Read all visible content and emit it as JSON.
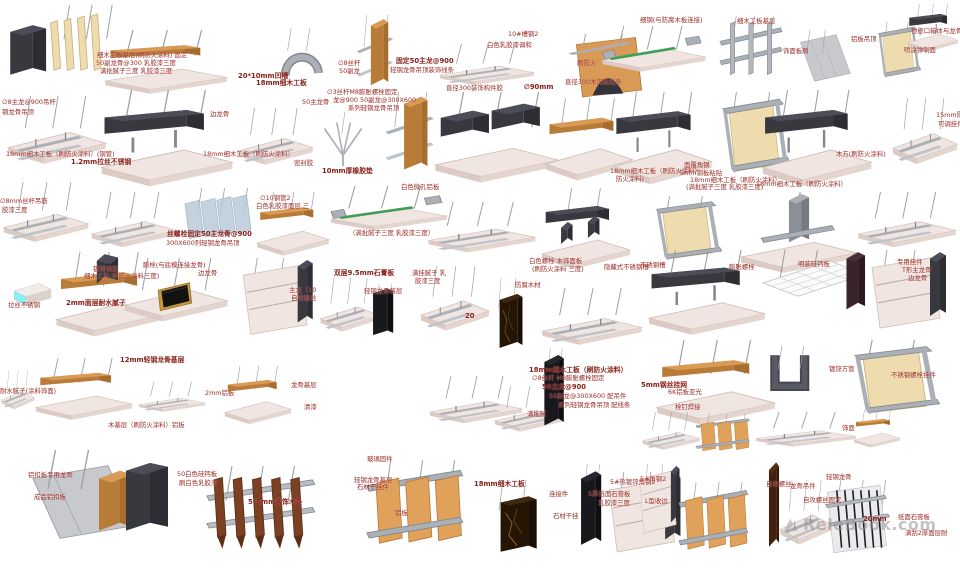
{
  "page": {
    "background": "#ffffff"
  },
  "watermark": {
    "text": "ReleBook.com"
  },
  "palette": {
    "annotation_red": "#9c2a24",
    "slab_pink": "#f1e5e1",
    "metal_gray": "#aab0b6",
    "charcoal": "#4d4d59",
    "wood_orange": "#d89a55",
    "green_strip": "#3f9e56",
    "cyan": "#8ceef0",
    "marble_brown": "#241505",
    "slat_brown": "#7c4023"
  },
  "details": [
    {
      "v": "slatscream",
      "x": 8,
      "y": 5,
      "w": 112,
      "h": 90
    },
    {
      "v": "woodtop",
      "x": 100,
      "y": 30,
      "w": 132,
      "h": 68
    },
    {
      "v": "grayarch",
      "x": 266,
      "y": 28,
      "w": 72,
      "h": 60
    },
    {
      "v": "woodvert",
      "x": 350,
      "y": 15,
      "w": 58,
      "h": 85
    },
    {
      "v": "flat",
      "x": 436,
      "y": 44,
      "w": 102,
      "h": 52
    },
    {
      "v": "archwood",
      "x": 556,
      "y": 34,
      "w": 102,
      "h": 70
    },
    {
      "v": "greenstrip",
      "x": 598,
      "y": 26,
      "w": 112,
      "h": 62
    },
    {
      "v": "postsframe",
      "x": 714,
      "y": 16,
      "w": 74,
      "h": 78
    },
    {
      "v": "grayslant",
      "x": 794,
      "y": 30,
      "w": 64,
      "h": 62
    },
    {
      "v": "framebox",
      "x": 864,
      "y": 22,
      "w": 66,
      "h": 66
    },
    {
      "v": "darkroof",
      "x": 906,
      "y": 4,
      "w": 54,
      "h": 50
    },
    {
      "v": "flat",
      "x": 4,
      "y": 96,
      "w": 106,
      "h": 86
    },
    {
      "v": "darkroof",
      "x": 96,
      "y": 90,
      "w": 142,
      "h": 100
    },
    {
      "v": "flat",
      "x": 234,
      "y": 108,
      "w": 82,
      "h": 72
    },
    {
      "v": "bracket",
      "x": 312,
      "y": 112,
      "w": 62,
      "h": 60
    },
    {
      "v": "woodvert",
      "x": 376,
      "y": 92,
      "w": 78,
      "h": 94
    },
    {
      "v": "twindark",
      "x": 430,
      "y": 92,
      "w": 134,
      "h": 94
    },
    {
      "v": "woodtop",
      "x": 542,
      "y": 98,
      "w": 94,
      "h": 88
    },
    {
      "v": "darkroof",
      "x": 610,
      "y": 92,
      "w": 106,
      "h": 96
    },
    {
      "v": "framebox",
      "x": 700,
      "y": 92,
      "w": 104,
      "h": 96
    },
    {
      "v": "darkroof",
      "x": 758,
      "y": 90,
      "w": 118,
      "h": 100
    },
    {
      "v": "flat",
      "x": 890,
      "y": 98,
      "w": 70,
      "h": 84
    },
    {
      "v": "flat",
      "x": 0,
      "y": 182,
      "w": 92,
      "h": 76
    },
    {
      "v": "flat",
      "x": 88,
      "y": 192,
      "w": 92,
      "h": 70
    },
    {
      "v": "glass",
      "x": 178,
      "y": 188,
      "w": 88,
      "h": 70
    },
    {
      "v": "woodtop",
      "x": 254,
      "y": 192,
      "w": 78,
      "h": 68
    },
    {
      "v": "greenstrip",
      "x": 326,
      "y": 186,
      "w": 126,
      "h": 60
    },
    {
      "v": "flat",
      "x": 424,
      "y": 202,
      "w": 116,
      "h": 64
    },
    {
      "v": "darktable",
      "x": 538,
      "y": 188,
      "w": 96,
      "h": 80
    },
    {
      "v": "framebox",
      "x": 634,
      "y": 196,
      "w": 102,
      "h": 76
    },
    {
      "v": "steeltee",
      "x": 736,
      "y": 192,
      "w": 126,
      "h": 84
    },
    {
      "v": "flat",
      "x": 854,
      "y": 192,
      "w": 106,
      "h": 70
    },
    {
      "v": "cyanbox",
      "x": 8,
      "y": 272,
      "w": 60,
      "h": 58
    },
    {
      "v": "woodfin",
      "x": 52,
      "y": 252,
      "w": 112,
      "h": 90
    },
    {
      "v": "brush",
      "x": 120,
      "y": 258,
      "w": 112,
      "h": 86
    },
    {
      "v": "paneledge",
      "x": 230,
      "y": 258,
      "w": 94,
      "h": 86
    },
    {
      "v": "flat",
      "x": 318,
      "y": 278,
      "w": 64,
      "h": 68
    },
    {
      "v": "blackstone",
      "x": 354,
      "y": 284,
      "w": 56,
      "h": 62
    },
    {
      "v": "flat",
      "x": 418,
      "y": 266,
      "w": 74,
      "h": 82
    },
    {
      "v": "marble",
      "x": 484,
      "y": 278,
      "w": 52,
      "h": 80
    },
    {
      "v": "flat",
      "x": 538,
      "y": 288,
      "w": 108,
      "h": 72
    },
    {
      "v": "darkroof",
      "x": 644,
      "y": 250,
      "w": 126,
      "h": 88
    },
    {
      "v": "mesh",
      "x": 756,
      "y": 250,
      "w": 116,
      "h": 88
    },
    {
      "v": "paneledge",
      "x": 858,
      "y": 250,
      "w": 100,
      "h": 88
    },
    {
      "v": "flat",
      "x": 0,
      "y": 370,
      "w": 36,
      "h": 50
    },
    {
      "v": "woodtop",
      "x": 32,
      "y": 358,
      "w": 104,
      "h": 66
    },
    {
      "v": "flat",
      "x": 136,
      "y": 382,
      "w": 72,
      "h": 38
    },
    {
      "v": "woodtop",
      "x": 222,
      "y": 366,
      "w": 72,
      "h": 62
    },
    {
      "v": "flat",
      "x": 426,
      "y": 376,
      "w": 100,
      "h": 60
    },
    {
      "v": "flat",
      "x": 492,
      "y": 386,
      "w": 74,
      "h": 58
    },
    {
      "v": "blackstone",
      "x": 526,
      "y": 348,
      "w": 54,
      "h": 94
    },
    {
      "v": "woodtop",
      "x": 652,
      "y": 340,
      "w": 128,
      "h": 90
    },
    {
      "v": "udark",
      "x": 750,
      "y": 346,
      "w": 78,
      "h": 62
    },
    {
      "v": "framebox",
      "x": 826,
      "y": 340,
      "w": 132,
      "h": 88
    },
    {
      "v": "woodblock",
      "x": 24,
      "y": 450,
      "w": 150,
      "h": 104
    },
    {
      "v": "slatsbrown",
      "x": 202,
      "y": 466,
      "w": 120,
      "h": 92
    },
    {
      "v": "orangewall",
      "x": 360,
      "y": 460,
      "w": 114,
      "h": 104
    },
    {
      "v": "marble",
      "x": 476,
      "y": 480,
      "w": 82,
      "h": 82
    },
    {
      "v": "blackstone",
      "x": 562,
      "y": 464,
      "w": 56,
      "h": 98
    },
    {
      "v": "paneledge",
      "x": 596,
      "y": 472,
      "w": 96,
      "h": 90
    },
    {
      "v": "flat",
      "x": 640,
      "y": 412,
      "w": 62,
      "h": 48
    },
    {
      "v": "orangewall",
      "x": 692,
      "y": 414,
      "w": 64,
      "h": 46
    },
    {
      "v": "flat",
      "x": 752,
      "y": 412,
      "w": 108,
      "h": 44
    },
    {
      "v": "woodtop",
      "x": 852,
      "y": 410,
      "w": 50,
      "h": 40
    },
    {
      "v": "paneledge",
      "x": 632,
      "y": 464,
      "w": 54,
      "h": 78
    },
    {
      "v": "orangewall",
      "x": 674,
      "y": 482,
      "w": 82,
      "h": 84
    },
    {
      "v": "darkwood",
      "x": 756,
      "y": 460,
      "w": 36,
      "h": 102
    },
    {
      "v": "flat",
      "x": 778,
      "y": 480,
      "w": 56,
      "h": 82
    },
    {
      "v": "gypslats",
      "x": 816,
      "y": 480,
      "w": 80,
      "h": 82
    }
  ],
  "annotations": [
    {
      "t": "细木工板基层(刷防火涂料) 固定",
      "x": 97,
      "y": 52
    },
    {
      "t": "50副龙骨@300 乳胶漆三度",
      "x": 96,
      "y": 60
    },
    {
      "t": "满批腻子三度 乳胶漆三度",
      "x": 100,
      "y": 68
    },
    {
      "t": "20*10mm凹槽",
      "x": 238,
      "y": 73,
      "b": 1
    },
    {
      "t": "18mm细木工板",
      "x": 256,
      "y": 80,
      "b": 1
    },
    {
      "t": "∅8丝杆",
      "x": 338,
      "y": 60
    },
    {
      "t": "50副龙",
      "x": 339,
      "y": 68
    },
    {
      "t": "固定50主龙@900",
      "x": 396,
      "y": 58,
      "b": 1
    },
    {
      "t": "轻钢龙骨吊顶装饰线条",
      "x": 390,
      "y": 67
    },
    {
      "t": "∅3丝杆M8膨胀螺栓固定",
      "x": 327,
      "y": 89
    },
    {
      "t": "龙@900  50副龙@300X600",
      "x": 333,
      "y": 97
    },
    {
      "t": "系列轻钢龙骨吊顶",
      "x": 348,
      "y": 105
    },
    {
      "t": "直径300装饰构件胶",
      "x": 446,
      "y": 85
    },
    {
      "t": "∅90mm",
      "x": 524,
      "y": 84,
      "b": 1
    },
    {
      "t": "白色乳胶漆调和",
      "x": 487,
      "y": 42
    },
    {
      "t": "10#槽钢2",
      "x": 508,
      "y": 31
    },
    {
      "t": "直径300木饰面线条",
      "x": 565,
      "y": 79
    },
    {
      "t": "刷防火",
      "x": 577,
      "y": 60
    },
    {
      "t": "细钢(与防腐木板连接)",
      "x": 640,
      "y": 17
    },
    {
      "t": "细木工板基层",
      "x": 737,
      "y": 18
    },
    {
      "t": "铝板吊顶",
      "x": 851,
      "y": 36
    },
    {
      "t": "饰面板刷",
      "x": 783,
      "y": 48
    },
    {
      "t": "检修口箱体与龙骨",
      "x": 911,
      "y": 28
    },
    {
      "t": "喷涂弹制面",
      "x": 904,
      "y": 47
    },
    {
      "t": "∅8主龙@900吊杆",
      "x": 2,
      "y": 99
    },
    {
      "t": "钢龙骨吊顶",
      "x": 2,
      "y": 109
    },
    {
      "t": "边龙骨",
      "x": 210,
      "y": 111
    },
    {
      "t": "50主龙骨",
      "x": 302,
      "y": 99
    },
    {
      "t": "18mm细木工板（刷防火涂料）(钢管)",
      "x": 6,
      "y": 151
    },
    {
      "t": "1.2mm拉丝不锈钢",
      "x": 71,
      "y": 159,
      "b": 1
    },
    {
      "t": "18mm细木工板（刷防火涂料）",
      "x": 203,
      "y": 151
    },
    {
      "t": "密封胶",
      "x": 294,
      "y": 160
    },
    {
      "t": "10mm厚橡胶垫",
      "x": 322,
      "y": 168,
      "b": 1
    },
    {
      "t": "白色微孔铝板",
      "x": 401,
      "y": 184
    },
    {
      "t": "18mm细木工板（刷防火涂料）",
      "x": 610,
      "y": 168
    },
    {
      "t": "防火涂料)",
      "x": 616,
      "y": 176
    },
    {
      "t": "面覆角钢",
      "x": 684,
      "y": 162
    },
    {
      "t": "5mm钢板粘贴",
      "x": 680,
      "y": 170
    },
    {
      "t": "18mm细木工板（刷防火涂料）",
      "x": 690,
      "y": 177
    },
    {
      "t": "(满批腻子三度 乳胶漆三度)",
      "x": 686,
      "y": 184
    },
    {
      "t": "木方(刷防火涂料)",
      "x": 836,
      "y": 151
    },
    {
      "t": "18mm细木工板（刷防火涂料）",
      "x": 756,
      "y": 181
    },
    {
      "t": "15mm厚",
      "x": 936,
      "y": 112
    },
    {
      "t": "可调挂件",
      "x": 938,
      "y": 121
    },
    {
      "t": "∅8mm丝杆吊筋",
      "x": 0,
      "y": 198
    },
    {
      "t": "胶漆三度",
      "x": 2,
      "y": 207
    },
    {
      "t": "∅10钢管2",
      "x": 260,
      "y": 195
    },
    {
      "t": "白色乳胶漆面层 三",
      "x": 256,
      "y": 203
    },
    {
      "t": "丝螺栓固定50主龙骨@900",
      "x": 167,
      "y": 231,
      "b": 1
    },
    {
      "t": "300X600列轻钢龙骨吊顶",
      "x": 166,
      "y": 240
    },
    {
      "t": "（满批腻子三度 乳胶漆三度）",
      "x": 349,
      "y": 230
    },
    {
      "t": "镀锌钢筋",
      "x": 93,
      "y": 266
    },
    {
      "t": "细木工板(刷防火涂料三度)",
      "x": 84,
      "y": 273
    },
    {
      "t": "膨栓(与底模连接龙骨)",
      "x": 143,
      "y": 262
    },
    {
      "t": "边龙骨",
      "x": 198,
      "y": 270
    },
    {
      "t": "2mm面层耐水腻子",
      "x": 66,
      "y": 300,
      "b": 1
    },
    {
      "t": "拉丝不锈钢",
      "x": 8,
      "y": 302
    },
    {
      "t": "主龙（10",
      "x": 289,
      "y": 287
    },
    {
      "t": "自攻螺丝",
      "x": 291,
      "y": 295
    },
    {
      "t": "双层9.5mm石膏板",
      "x": 334,
      "y": 270,
      "b": 1
    },
    {
      "t": "满挂腻子 乳",
      "x": 412,
      "y": 270
    },
    {
      "t": "胶漆三度",
      "x": 415,
      "y": 278
    },
    {
      "t": "轻钢龙骨基层",
      "x": 364,
      "y": 288
    },
    {
      "t": "白色螺栓 木饰面板",
      "x": 529,
      "y": 258
    },
    {
      "t": "(刷防火涂料 三度)",
      "x": 532,
      "y": 266
    },
    {
      "t": "防腐木材",
      "x": 515,
      "y": 282
    },
    {
      "t": "隐藏式不锈钢槽",
      "x": 604,
      "y": 264
    },
    {
      "t": "20",
      "x": 465,
      "y": 313,
      "b": 1
    },
    {
      "t": "膨胀螺栓",
      "x": 729,
      "y": 264
    },
    {
      "t": "不锈钢槽",
      "x": 640,
      "y": 262
    },
    {
      "t": "明装硅钙板",
      "x": 798,
      "y": 261
    },
    {
      "t": "专用挂件",
      "x": 897,
      "y": 259
    },
    {
      "t": "T形主龙骨",
      "x": 902,
      "y": 267
    },
    {
      "t": "边龙骨",
      "x": 908,
      "y": 275
    },
    {
      "t": "12mm轻钢龙骨基层",
      "x": 120,
      "y": 357,
      "b": 1
    },
    {
      "t": "耐水腻子(涂料饰面)",
      "x": 0,
      "y": 388
    },
    {
      "t": "木基层（刷防火涂料）铝板",
      "x": 108,
      "y": 422
    },
    {
      "t": "2mm铝板",
      "x": 205,
      "y": 390
    },
    {
      "t": "龙骨基层",
      "x": 291,
      "y": 382
    },
    {
      "t": "清漆",
      "x": 304,
      "y": 404
    },
    {
      "t": "18mm细木工板（刷防火涂料）",
      "x": 529,
      "y": 367,
      "b": 1
    },
    {
      "t": "∅8丝杆 M8膨胀螺栓固定",
      "x": 532,
      "y": 375
    },
    {
      "t": "50主龙@900",
      "x": 542,
      "y": 384,
      "b": 1
    },
    {
      "t": "50副龙@300X600 配吊件",
      "x": 549,
      "y": 393
    },
    {
      "t": "系列轻钢龙骨吊顶 配线条",
      "x": 558,
      "y": 402
    },
    {
      "t": "满批腻",
      "x": 527,
      "y": 411
    },
    {
      "t": "5mm钢丝挂网",
      "x": 641,
      "y": 382,
      "b": 1
    },
    {
      "t": "6K铝板亚光",
      "x": 668,
      "y": 389
    },
    {
      "t": "栓钉焊接",
      "x": 675,
      "y": 404
    },
    {
      "t": "镀锌方管",
      "x": 829,
      "y": 366
    },
    {
      "t": "不锈钢螺栓挂件",
      "x": 891,
      "y": 372
    },
    {
      "t": "铝扣板专用龙骨",
      "x": 28,
      "y": 472
    },
    {
      "t": "成品铝扣板",
      "x": 34,
      "y": 494
    },
    {
      "t": "50白色硅钙板",
      "x": 177,
      "y": 471
    },
    {
      "t": "刷白色乳胶漆",
      "x": 179,
      "y": 480
    },
    {
      "t": "5*5mm装饰木条",
      "x": 248,
      "y": 499,
      "b": 1
    },
    {
      "t": "玻璃固件",
      "x": 367,
      "y": 456
    },
    {
      "t": "轻钢龙骨基层",
      "x": 354,
      "y": 477
    },
    {
      "t": "石材干挂件",
      "x": 357,
      "y": 484
    },
    {
      "t": "铝板",
      "x": 395,
      "y": 510
    },
    {
      "t": "18mm细木工板",
      "x": 474,
      "y": 481,
      "b": 1
    },
    {
      "t": "连接件",
      "x": 549,
      "y": 491
    },
    {
      "t": "石材干挂",
      "x": 553,
      "y": 513
    },
    {
      "t": "5#热镀锌角钢2",
      "x": 610,
      "y": 479
    },
    {
      "t": "5厚纸面石膏板",
      "x": 588,
      "y": 491
    },
    {
      "t": "乳胶漆三度",
      "x": 598,
      "y": 500
    },
    {
      "t": "5#角钢2",
      "x": 640,
      "y": 476
    },
    {
      "t": "L型收边",
      "x": 645,
      "y": 498
    },
    {
      "t": "饰面",
      "x": 842,
      "y": 425
    },
    {
      "t": "自攻螺丝",
      "x": 766,
      "y": 481
    },
    {
      "t": "轻钢龙骨",
      "x": 826,
      "y": 474
    },
    {
      "t": "龙骨吊件",
      "x": 790,
      "y": 483
    },
    {
      "t": "自攻螺丝固定",
      "x": 803,
      "y": 497
    },
    {
      "t": "20mm",
      "x": 863,
      "y": 516,
      "b": 1
    },
    {
      "t": "纸面石膏板",
      "x": 898,
      "y": 514
    },
    {
      "t": "满刮2厚面层耐",
      "x": 905,
      "y": 530
    }
  ]
}
